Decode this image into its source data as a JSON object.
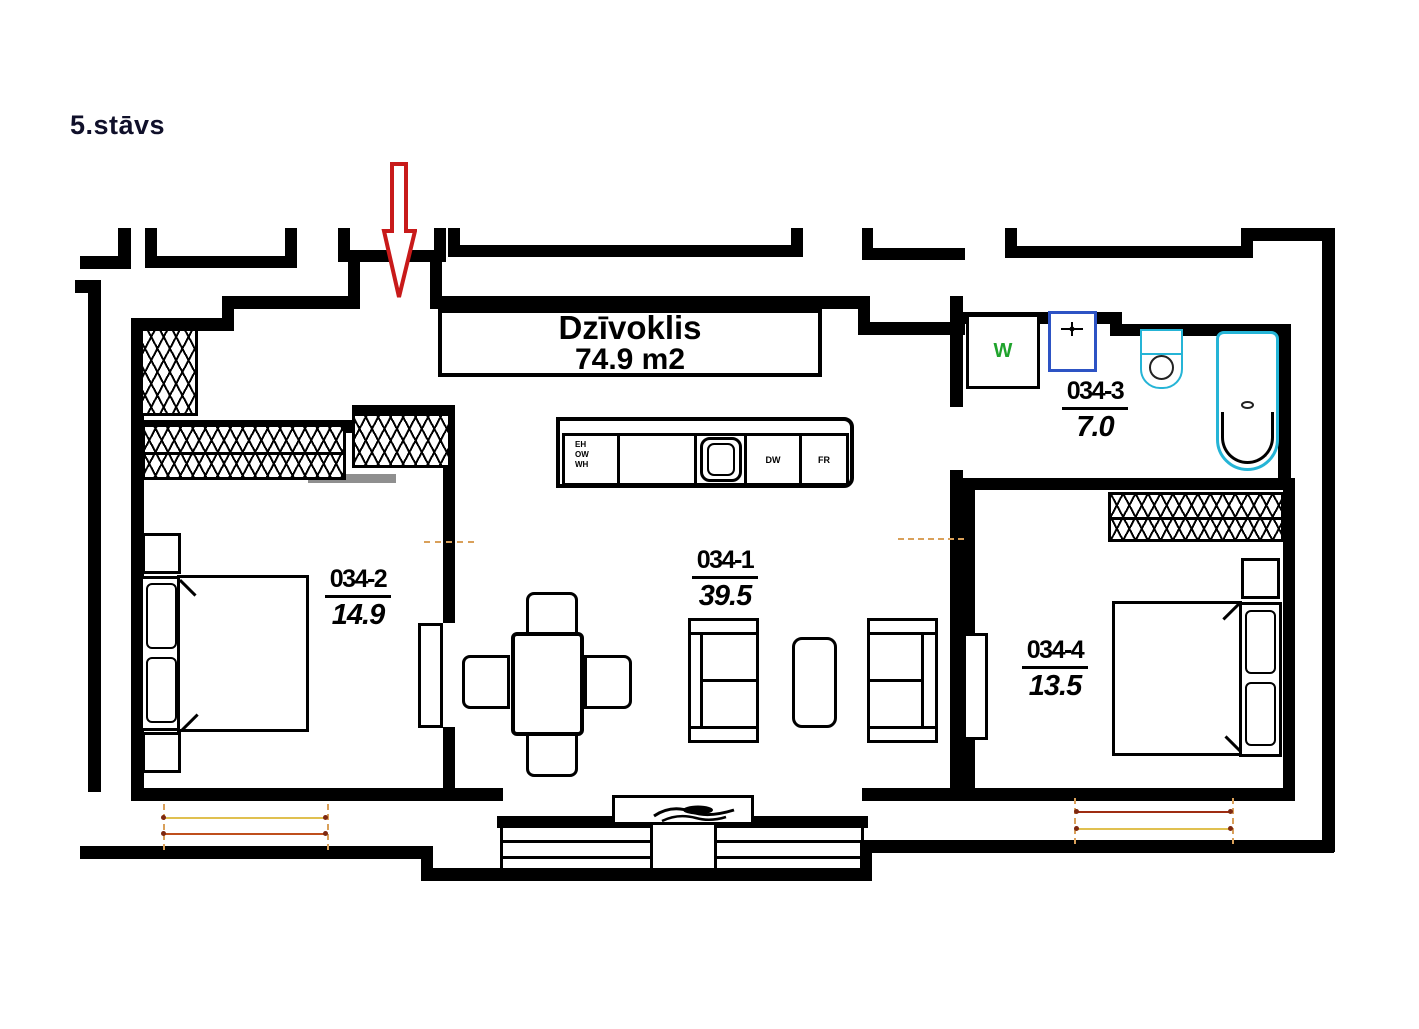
{
  "floor_label": "5.stāvs",
  "apartment": {
    "name": "Dzīvoklis",
    "area": "74.9 m2"
  },
  "rooms": {
    "living": {
      "id": "034-1",
      "area": "39.5"
    },
    "bedroom_left": {
      "id": "034-2",
      "area": "14.9"
    },
    "bathroom": {
      "id": "034-3",
      "area": "7.0"
    },
    "bedroom_right": {
      "id": "034-4",
      "area": "13.5"
    }
  },
  "kitchen": {
    "stack_labels": [
      "EH",
      "OW",
      "WH"
    ],
    "dishwasher_label": "DW",
    "fridge_label": "FR"
  },
  "bathroom_fixtures": {
    "washer_label": "W"
  },
  "colors": {
    "wall": "#000000",
    "floor_title": "#10102a",
    "entry_arrow": "#c81a1a",
    "fixture_cyan": "#25b4d6",
    "sink_blue": "#2d53c4",
    "washer_green": "#1fa32c",
    "dim_yellow": "#e0c050",
    "dim_orange": "#bf4f1c",
    "dim_dark_red": "#9e2c12"
  }
}
